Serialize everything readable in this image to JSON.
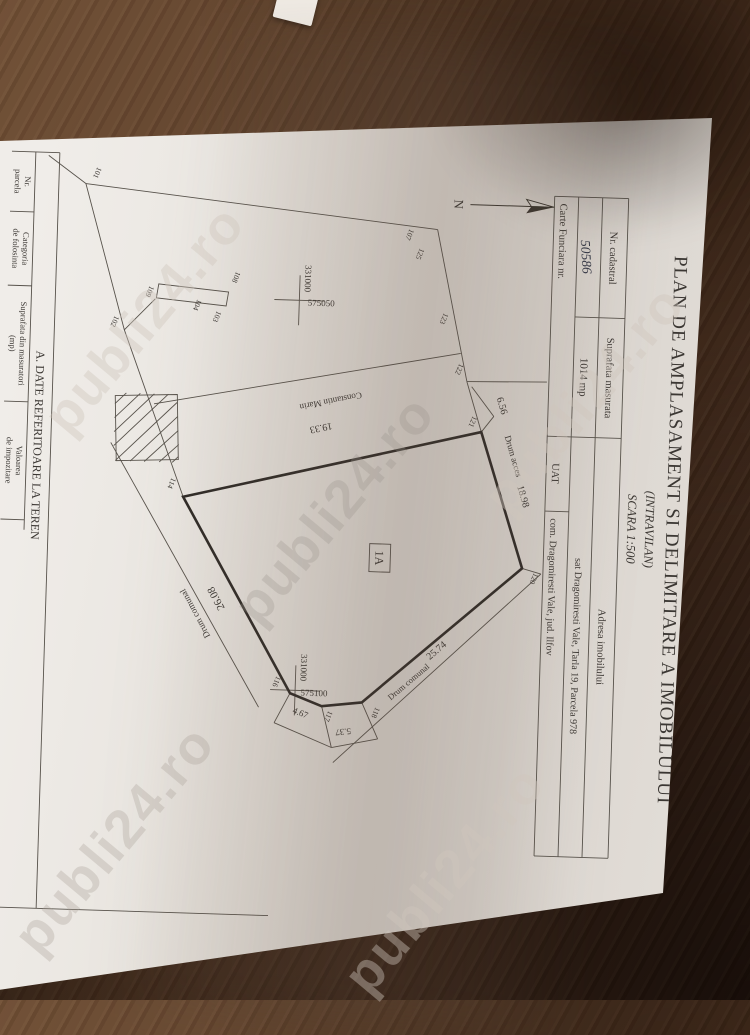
{
  "colors": {
    "paper": "#e8e4de",
    "wood": "#4e3321",
    "ink": "#3b3733"
  },
  "watermark": {
    "text": "publi24.ro"
  },
  "document": {
    "title": "PLAN DE AMPLASAMENT SI DELIMITARE A IMOBILULUI",
    "subtitle": "(INTRAVILAN)",
    "scale_label": "SCARA 1:500",
    "header_table": {
      "nr_cadastral_label": "Nr. cadastral",
      "nr_cadastral_value": "50586",
      "suprafata_label": "Suprafata masurata",
      "suprafata_value": "1014 mp",
      "adresa_label": "Adresa imobilului",
      "adresa_value": "sat Dragomiresti Vale, Tarla 19, Parcela 978",
      "carte_funciara_label": "Carte Funciara nr.",
      "uat_label": "UAT",
      "uat_value": "com. Dragomiresti Vale, jud. Ilfov"
    },
    "north_label": "N",
    "plan": {
      "parcel_id": "1A",
      "grid": {
        "northing": "331000",
        "easting_west": "575050",
        "easting_east": "575100"
      },
      "measurements": {
        "m_19_33": "19.33",
        "m_18_98": "18.98",
        "m_6_56": "6.56",
        "m_25_74": "25.74",
        "m_26_08": "26.08",
        "m_4_67": "4.67",
        "m_5_37": "5.37"
      },
      "roads": {
        "drum_acces": "Drum acces",
        "drum_comunal_1": "Drum comunal",
        "drum_comunal_2": "Drum comunal"
      },
      "neighbor": "Constantin Marin",
      "vertex_labels": [
        "101",
        "102",
        "103",
        "104",
        "107",
        "108",
        "109",
        "114",
        "116",
        "117",
        "118",
        "120",
        "121",
        "122",
        "123",
        "125"
      ]
    },
    "section_a": {
      "title": "A. DATE REFERITOARE LA TEREN",
      "columns": [
        {
          "line1": "Nr.",
          "line2": "parcela"
        },
        {
          "line1": "Categoria",
          "line2": "de folosinta"
        },
        {
          "line1": "Suprafata din masuratori",
          "line2": "(mp)"
        },
        {
          "line1": "Valoarea",
          "line2": "de impozitare"
        }
      ]
    }
  }
}
